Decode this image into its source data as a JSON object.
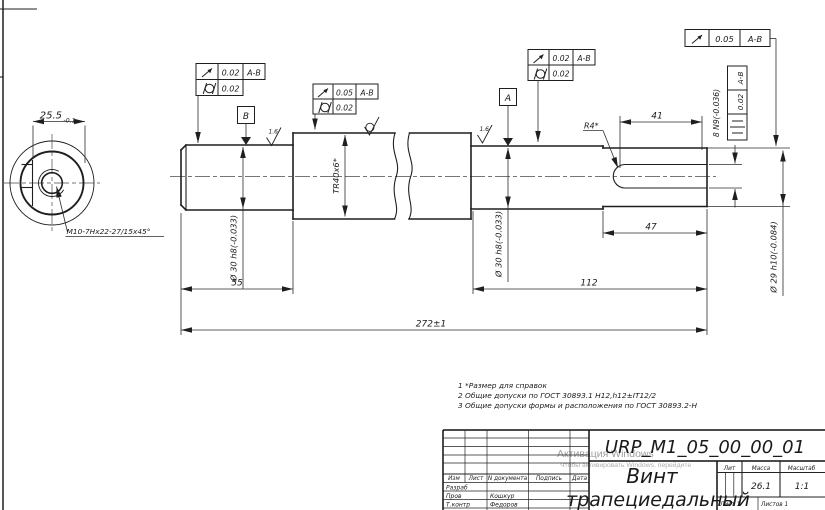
{
  "sheet": {
    "background": "#ffffff",
    "line_color": "#1f1f1f",
    "watermark_color": "#9e9e9e"
  },
  "left_view": {
    "dim_width": "25.5",
    "dim_width_tol": "-0.1",
    "thread_callout": "M10-7Hx22-27/15x45°"
  },
  "frames": {
    "f1_runout": "0.02",
    "f1_datum": "A-B",
    "f1_cyl": "0.02",
    "f2_runout": "0.05",
    "f2_datum": "A-B",
    "f2_cyl": "0.02",
    "f3_runout": "0.02",
    "f3_datum": "A-B",
    "f3_cyl": "0.02",
    "f4_runout": "0.05",
    "f4_datum": "A-B",
    "f5_sym_value": "0.02",
    "f5_sym_datum": "A-B"
  },
  "datums": {
    "a": "A",
    "b": "B"
  },
  "dims": {
    "len55": "55",
    "len112": "112",
    "len47": "47",
    "len41": "41",
    "overall": "272±1",
    "dia30_left": "Ø 30 h8(-0.033)",
    "dia30_right": "Ø 30 h8(-0.033)",
    "dia29": "Ø 29 h10(-0.084)",
    "thread_tr": "TR40x6*",
    "radius": "R4*",
    "keyway_width": "8 N9(-0.036)",
    "roughness_1": "1.6",
    "roughness_2": "1.6"
  },
  "notes": {
    "n1": "1 *Размер для справок",
    "n2": "2 Общие допуски по ГОСТ 30893.1 H12,h12±IT12/2",
    "n3": "3 Общие допуски формы и расположения по ГОСТ 30893.2-Н"
  },
  "title_block": {
    "doc_number": "URP_M1_05_00_00_01",
    "part_name_1": "Винт",
    "part_name_2": "трапециедальный",
    "col_izm": "Изм",
    "col_list": "Лист",
    "col_doc": "N документа",
    "col_sign": "Подпись",
    "col_date": "Дата",
    "row1_label": "Разраб",
    "row2_label": "Пров",
    "row2_name": "Кошкур",
    "row3_label": "Т.контр",
    "row3_name": "Федоров",
    "lit_label": "Лит",
    "mass_label": "Масса",
    "scale_label": "Масштаб",
    "mass_value": "26.1",
    "scale_value": "1:1",
    "sheet_label": "Лист 1",
    "sheets_label": "Листов 1"
  },
  "watermark": {
    "line1": "Активация Windows",
    "line2": "Чтобы активировать Windows, перейдите"
  }
}
